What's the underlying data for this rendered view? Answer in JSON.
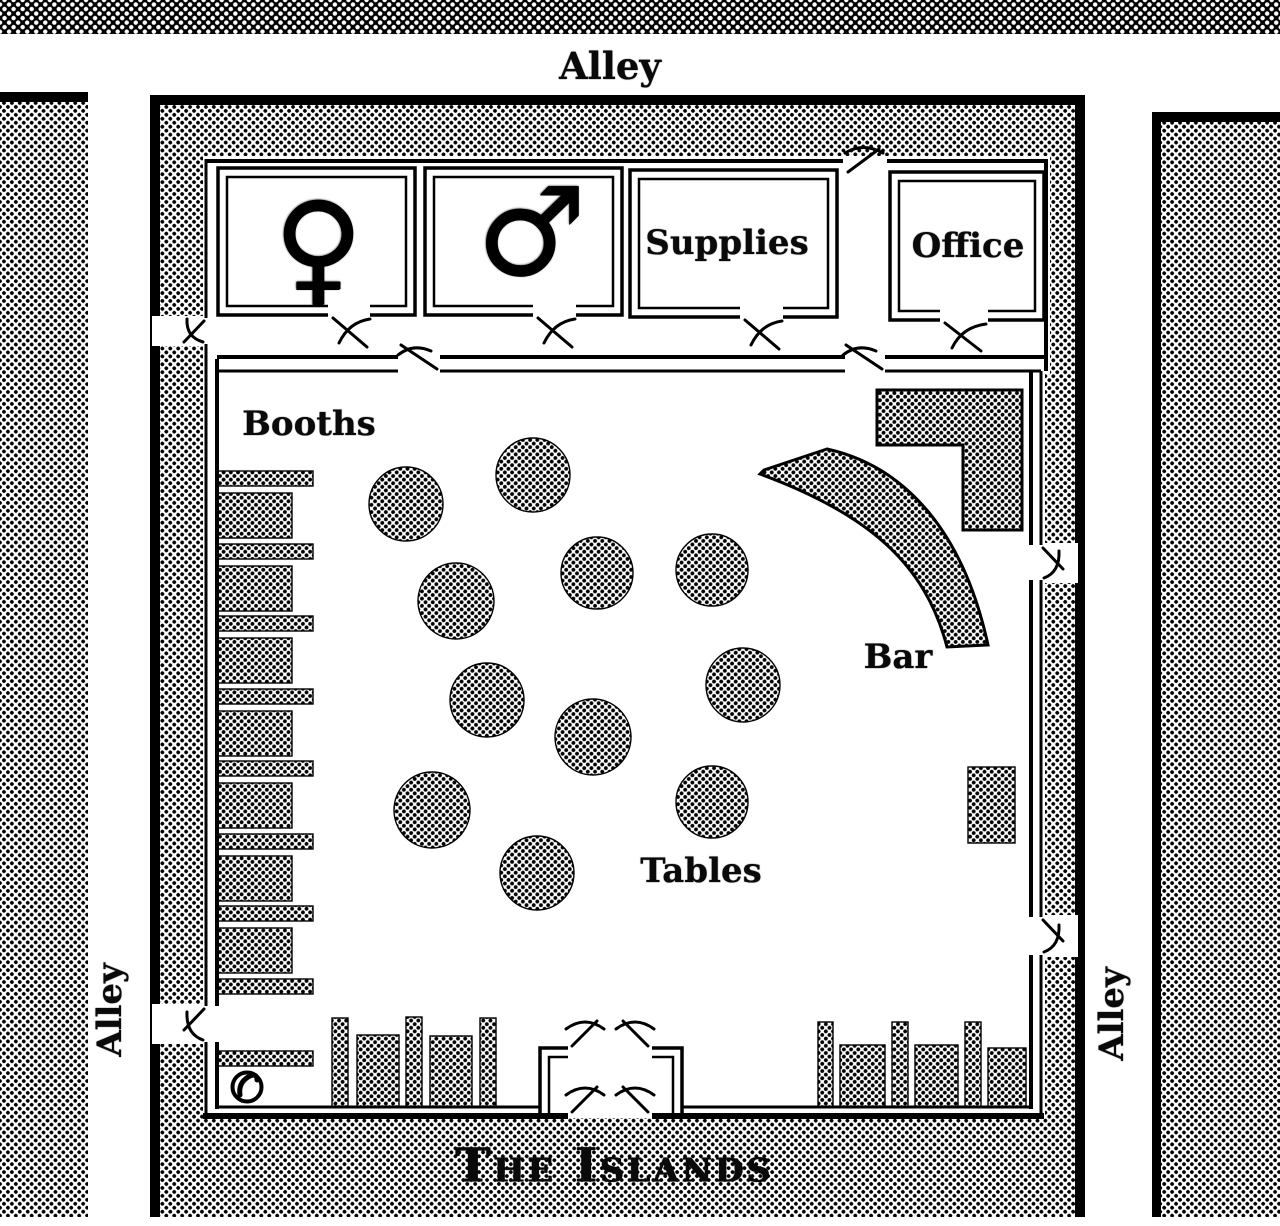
{
  "colors": {
    "ink": "#000000",
    "paper": "#ffffff"
  },
  "streets": {
    "top": "Alley",
    "left": "Alley",
    "right": "Alley"
  },
  "building": {
    "title": "The Islands"
  },
  "rooms": {
    "womens": {
      "symbol": "♀",
      "name": "womens-restroom"
    },
    "mens": {
      "symbol": "♂",
      "name": "mens-restroom"
    },
    "supplies": {
      "label": "Supplies"
    },
    "office": {
      "label": "Office"
    }
  },
  "areas": {
    "booths": {
      "label": "Booths"
    },
    "bar": {
      "label": "Bar"
    },
    "tables": {
      "label": "Tables"
    }
  },
  "icons": {
    "phone": "circled-telephone-handset"
  }
}
